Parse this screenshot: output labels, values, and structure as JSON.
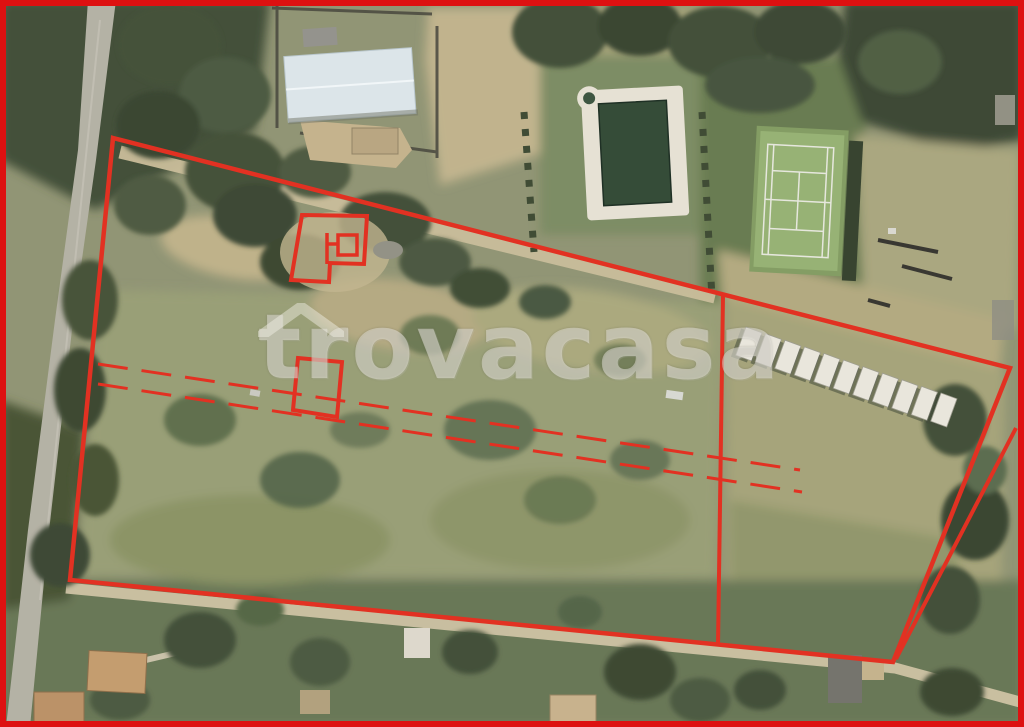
{
  "watermark": {
    "text": "trovacasa",
    "roof_icon": "house-roof-icon",
    "color": "rgba(245,242,233,0.45)"
  },
  "frame": {
    "color": "#dd1111",
    "thickness_px": 6
  },
  "annotation": {
    "stroke_color": "#e23122",
    "shapes": [
      {
        "id": "main-boundary",
        "type": "polygon",
        "points": "113,138 1010,368 893,662 70,580",
        "width": 4.5
      },
      {
        "id": "parcel-divider",
        "type": "polyline",
        "points": "723,295 718,646",
        "width": 4
      },
      {
        "id": "right-secondary-line",
        "type": "polyline",
        "points": "1016,428 896,659",
        "width": 4
      },
      {
        "id": "building-footprint",
        "type": "path",
        "d": "M302,215 L367,216 L364,264 L330,263 L329,282 L291,280 Z",
        "width": 4
      },
      {
        "id": "building-footprint-inner",
        "type": "path",
        "d": "M327,233 L327,264 M327,244 L338,244 M338,235 h19 v20 h-19 z",
        "width": 3.5
      },
      {
        "id": "small-plot-footprint",
        "type": "polygon",
        "points": "298,358 342,362 337,417 293,410",
        "width": 4
      },
      {
        "id": "dashed-utility-line-1",
        "type": "polyline",
        "points": "98,364 800,470",
        "width": 3,
        "dash": "30 14"
      },
      {
        "id": "dashed-utility-line-2",
        "type": "polyline",
        "points": "98,384 802,492",
        "width": 3,
        "dash": "30 14"
      }
    ]
  },
  "photo": {
    "description": "aerial-orthophoto-of-rural-parcels",
    "features": [
      "asphalt-road",
      "farm-warehouse",
      "swimming-pool",
      "tennis-court",
      "caravan-row",
      "dirt-tracks",
      "tree-groves",
      "scrub-fields",
      "houses"
    ],
    "caravan_row": {
      "count": 11,
      "start": [
        746,
        327
      ],
      "step": [
        19.5,
        6.6
      ],
      "size": [
        17,
        30
      ],
      "angle": 20
    }
  }
}
